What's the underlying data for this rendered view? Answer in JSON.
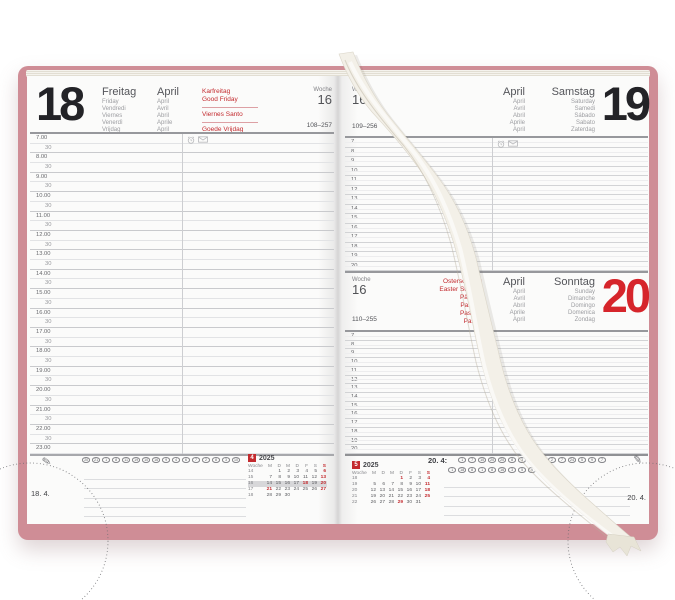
{
  "colors": {
    "cover": "#cf8d96",
    "accent_red": "#c32a2e",
    "big_day_red": "#d6252b",
    "ribbon": "#f3f0e8"
  },
  "left_page": {
    "big_day": "18",
    "day_names": [
      "Freitag",
      "Friday",
      "Vendredi",
      "Viernes",
      "Venerdì",
      "Vrijdag"
    ],
    "month_names": [
      "April",
      "April",
      "Avril",
      "Abril",
      "Aprile",
      "April"
    ],
    "holidays": [
      "Karfreitag",
      "Good Friday",
      "Viernes Santo",
      "Goede Vrijdag"
    ],
    "week_label": "Woche",
    "week_number": "16",
    "day_of_year": "108–257",
    "time_slots": [
      "7.00",
      "30",
      "8.00",
      "30",
      "9.00",
      "30",
      "10.00",
      "30",
      "11.00",
      "30",
      "12.00",
      "30",
      "13.00",
      "30",
      "14.00",
      "30",
      "15.00",
      "30",
      "16.00",
      "30",
      "17.00",
      "30",
      "18.00",
      "30",
      "19.00",
      "30",
      "20.00",
      "30",
      "21.00",
      "30",
      "22.00",
      "30",
      "23.00"
    ],
    "circles": [
      "20",
      "21",
      "1",
      "8",
      "11",
      "19",
      "10",
      "16",
      "9",
      "4",
      "6",
      "7",
      "2",
      "8",
      "3",
      "10"
    ],
    "corner_date": "18. 4.",
    "mini_calendar": {
      "month": "4",
      "year": "2025",
      "week_col": "Woche",
      "day_headers": [
        "M",
        "D",
        "M",
        "D",
        "F",
        "S",
        "S"
      ],
      "rows": [
        {
          "week": "14",
          "days": [
            "",
            "1",
            "2",
            "3",
            "4",
            "5",
            "6"
          ],
          "red": [
            "6"
          ],
          "highlight": false
        },
        {
          "week": "15",
          "days": [
            "7",
            "8",
            "9",
            "10",
            "11",
            "12",
            "13"
          ],
          "red": [
            "13"
          ],
          "highlight": false
        },
        {
          "week": "16",
          "days": [
            "14",
            "15",
            "16",
            "17",
            "18",
            "19",
            "20"
          ],
          "red": [
            "18",
            "20"
          ],
          "highlight": true
        },
        {
          "week": "17",
          "days": [
            "21",
            "22",
            "23",
            "24",
            "25",
            "26",
            "27"
          ],
          "red": [
            "21",
            "27"
          ],
          "highlight": false
        },
        {
          "week": "18",
          "days": [
            "28",
            "29",
            "30",
            "",
            "",
            "",
            ""
          ],
          "red": [],
          "highlight": false
        }
      ]
    }
  },
  "right_page": {
    "saturday": {
      "big_day": "19",
      "week_label": "Woche",
      "week_number": "16",
      "day_of_year": "109–256",
      "month_names": [
        "April",
        "April",
        "Avril",
        "Abril",
        "Aprile",
        "April"
      ],
      "day_names": [
        "Samstag",
        "Saturday",
        "Samedi",
        "Sábado",
        "Sabato",
        "Zaterdag"
      ],
      "hours": [
        "7",
        "8",
        "9",
        "10",
        "11",
        "12",
        "13",
        "14",
        "15",
        "16",
        "17",
        "18",
        "19",
        "20"
      ]
    },
    "sunday": {
      "big_day": "20",
      "week_label": "Woche",
      "week_number": "16",
      "day_of_year": "110–255",
      "holidays": [
        "Ostersonntag",
        "Easter Sunday",
        "Pâques",
        "Pascua",
        "Pasqua",
        "Pasen"
      ],
      "month_names": [
        "April",
        "April",
        "Avril",
        "Abril",
        "Aprile",
        "April"
      ],
      "day_names": [
        "Sonntag",
        "Sunday",
        "Dimanche",
        "Domingo",
        "Domenica",
        "Zondag"
      ],
      "hours": [
        "7",
        "8",
        "9",
        "10",
        "11",
        "12",
        "13",
        "14",
        "15",
        "16",
        "17",
        "18",
        "19",
        "20"
      ]
    },
    "circles_label": "20. 4:",
    "circles_row1": [
      "1",
      "7",
      "10",
      "20",
      "20",
      "8",
      "3",
      "16",
      "4",
      "2",
      "7",
      "24",
      "5",
      "9",
      "7"
    ],
    "circles_row2": [
      "1",
      "18",
      "8",
      "1",
      "8",
      "16",
      "3",
      "5",
      "9",
      "12",
      "10"
    ],
    "corner_date": "20. 4.",
    "mini_calendar": {
      "month": "5",
      "year": "2025",
      "week_col": "Woche",
      "day_headers": [
        "M",
        "D",
        "M",
        "D",
        "F",
        "S",
        "S"
      ],
      "rows": [
        {
          "week": "18",
          "days": [
            "",
            "",
            "",
            "1",
            "2",
            "3",
            "4"
          ],
          "red": [
            "1",
            "4"
          ],
          "highlight": false
        },
        {
          "week": "19",
          "days": [
            "5",
            "6",
            "7",
            "8",
            "9",
            "10",
            "11"
          ],
          "red": [
            "11"
          ],
          "highlight": false
        },
        {
          "week": "20",
          "days": [
            "12",
            "13",
            "14",
            "15",
            "16",
            "17",
            "18"
          ],
          "red": [
            "18"
          ],
          "highlight": false
        },
        {
          "week": "21",
          "days": [
            "19",
            "20",
            "21",
            "22",
            "23",
            "24",
            "25"
          ],
          "red": [
            "25"
          ],
          "highlight": false
        },
        {
          "week": "22",
          "days": [
            "26",
            "27",
            "28",
            "29",
            "30",
            "31",
            ""
          ],
          "red": [
            "29"
          ],
          "highlight": false
        }
      ]
    }
  }
}
